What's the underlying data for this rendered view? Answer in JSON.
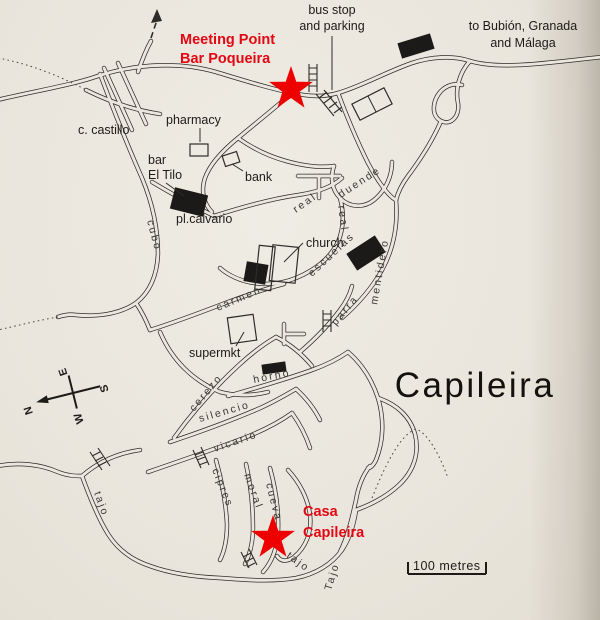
{
  "title": "Capileira",
  "colors": {
    "paper": "#ebe7de",
    "ink": "#2e2c29",
    "red_accent": "#e30613",
    "star_red": "#ee0000",
    "street_text": "#3a3833"
  },
  "map": {
    "scale": {
      "label": "100 metres"
    },
    "compass": {
      "n": "N",
      "e": "E",
      "s": "S",
      "w": "W"
    },
    "markers": [
      {
        "id": "meeting-point-star",
        "x": 291,
        "y": 89
      },
      {
        "id": "casa-capileira-star",
        "x": 273,
        "y": 538
      }
    ],
    "labels": [
      {
        "id": "bus-stop",
        "lines": [
          "bus stop",
          "and parking"
        ],
        "x": 332,
        "y": 14,
        "anchor": "middle",
        "cls": "poi",
        "lh": 16
      },
      {
        "id": "to-bubion",
        "lines": [
          "to Bubión, Granada",
          "and Málaga"
        ],
        "x": 523,
        "y": 30,
        "anchor": "middle",
        "cls": "poi",
        "lh": 17
      },
      {
        "id": "meeting-point",
        "lines": [
          "Meeting Point",
          "Bar Poqueira"
        ],
        "x": 180,
        "y": 44,
        "anchor": "start",
        "cls": "red",
        "lh": 19
      },
      {
        "id": "c-castillo",
        "lines": [
          "c. castillo"
        ],
        "x": 78,
        "y": 134,
        "anchor": "start",
        "cls": "poi",
        "lh": 16
      },
      {
        "id": "pharmacy",
        "lines": [
          "pharmacy"
        ],
        "x": 166,
        "y": 124,
        "anchor": "start",
        "cls": "poi",
        "lh": 16
      },
      {
        "id": "bar-el-tilo",
        "lines": [
          "bar",
          "El Tilo"
        ],
        "x": 148,
        "y": 164,
        "anchor": "start",
        "cls": "poi",
        "lh": 15
      },
      {
        "id": "bank",
        "lines": [
          "bank"
        ],
        "x": 245,
        "y": 181,
        "anchor": "start",
        "cls": "poi",
        "lh": 16
      },
      {
        "id": "pl-calvario",
        "lines": [
          "pl.calvario"
        ],
        "x": 176,
        "y": 223,
        "anchor": "start",
        "cls": "poi",
        "lh": 16
      },
      {
        "id": "church",
        "lines": [
          "church"
        ],
        "x": 306,
        "y": 247,
        "anchor": "start",
        "cls": "poi",
        "lh": 16
      },
      {
        "id": "supermkt",
        "lines": [
          "supermkt"
        ],
        "x": 189,
        "y": 357,
        "anchor": "start",
        "cls": "poi",
        "lh": 16
      },
      {
        "id": "casa-capileira",
        "lines": [
          "Casa",
          "Capileira"
        ],
        "x": 303,
        "y": 516,
        "anchor": "start",
        "cls": "red",
        "lh": 21
      }
    ],
    "street_labels": [
      {
        "text": "real",
        "x": 296,
        "y": 213,
        "rot": -35
      },
      {
        "text": "real",
        "x": 338,
        "y": 206,
        "rot": 82
      },
      {
        "text": "duende",
        "x": 341,
        "y": 198,
        "rot": -33
      },
      {
        "text": "escuelas",
        "x": 312,
        "y": 277,
        "rot": -43,
        "sp": 3
      },
      {
        "text": "mentidero",
        "x": 377,
        "y": 305,
        "rot": -80,
        "sp": 2.6
      },
      {
        "text": "parra",
        "x": 336,
        "y": 326,
        "rot": -50,
        "sp": 3
      },
      {
        "text": "carmen",
        "x": 218,
        "y": 311,
        "rot": -23,
        "sp": 3
      },
      {
        "text": "cubo",
        "x": 147,
        "y": 221,
        "rot": 75
      },
      {
        "text": "cerezo",
        "x": 194,
        "y": 412,
        "rot": -50,
        "sp": 3
      },
      {
        "text": "horno",
        "x": 254,
        "y": 383,
        "rot": -11,
        "sp": 4
      },
      {
        "text": "silencio",
        "x": 200,
        "y": 422,
        "rot": -16,
        "sp": 3
      },
      {
        "text": "vicario",
        "x": 215,
        "y": 452,
        "rot": -19,
        "sp": 3
      },
      {
        "text": "cipres",
        "x": 212,
        "y": 470,
        "rot": 68
      },
      {
        "text": "moral",
        "x": 244,
        "y": 475,
        "rot": 70
      },
      {
        "text": "cueva",
        "x": 266,
        "y": 484,
        "rot": 76
      },
      {
        "text": "tajo",
        "x": 94,
        "y": 493,
        "rot": 70,
        "sp": 3
      },
      {
        "text": "tajo",
        "x": 286,
        "y": 557,
        "rot": 36,
        "sp": 4
      },
      {
        "text": "Tajo",
        "x": 331,
        "y": 591,
        "rot": -73,
        "sp": 3
      }
    ]
  }
}
